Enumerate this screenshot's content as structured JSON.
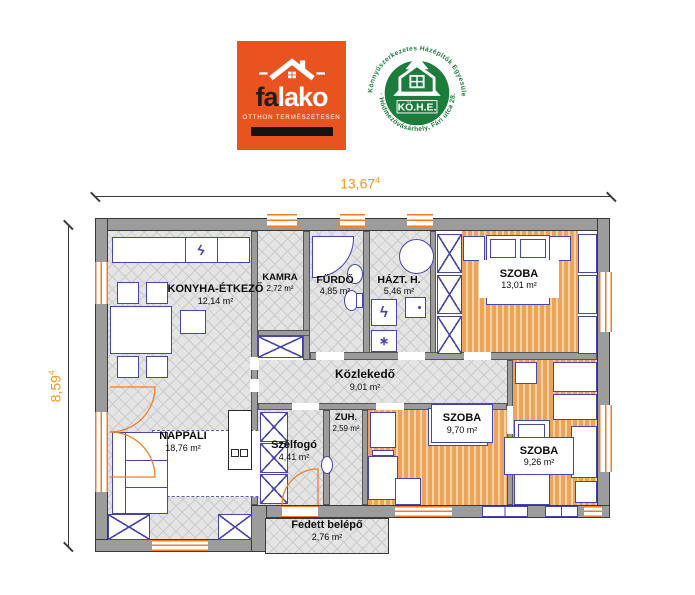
{
  "colors": {
    "wall_gray": "#9c9c9c",
    "outline_dark": "#3a3a3a",
    "furniture_navy": "#4646a8",
    "opening_orange": "#ee7e2b",
    "dimension_orange": "#f7941d",
    "hatch_floor": "#e4e4e4",
    "wood_floor": "#eca45d",
    "falako_orange": "#e8531f",
    "kohe_green": "#1c7c3c"
  },
  "logos": {
    "falako": {
      "brand_dark": "fa",
      "brand_light": "lako",
      "tagline": "OTTHON TERMÉSZETESEN"
    },
    "kohe": {
      "arc_top": "Könnyűszerkezetes Házépítők Egyesülete",
      "arc_bottom": "· Hódmezővásárhely, Fári utca 28. ·",
      "center": "KÖ.H.E."
    }
  },
  "dimensions": {
    "width_value": "13,67",
    "width_sup": "4",
    "height_value": "8,59",
    "height_sup": "4"
  },
  "rooms": {
    "konyha": {
      "name": "KONYHA-ÉTKEZŐ",
      "area": "12,14 m²"
    },
    "kamra": {
      "name": "KAMRA",
      "area": "2,72 m²"
    },
    "furdo": {
      "name": "FÜRDŐ",
      "area": "4,85 m²"
    },
    "hazt": {
      "name": "HÁZT. H.",
      "area": "5,46 m²"
    },
    "szoba1": {
      "name": "SZOBA",
      "area": "13,01 m²"
    },
    "kozlekedo": {
      "name": "Közlekedő",
      "area": "9,01 m²"
    },
    "nappali": {
      "name": "NAPPALI",
      "area": "18,76 m²"
    },
    "szelfogo": {
      "name": "Szélfogó",
      "area": "4,41 m²"
    },
    "zuh": {
      "name": "ZUH.",
      "area": "2,59 m²"
    },
    "szoba2": {
      "name": "SZOBA",
      "area": "9,70 m²"
    },
    "szoba3": {
      "name": "SZOBA",
      "area": "9,26 m²"
    },
    "fedett": {
      "name": "Fedett belépő",
      "area": "2,76 m²"
    }
  },
  "symbols": {
    "lightning": "ϟ",
    "vent": "∗"
  }
}
